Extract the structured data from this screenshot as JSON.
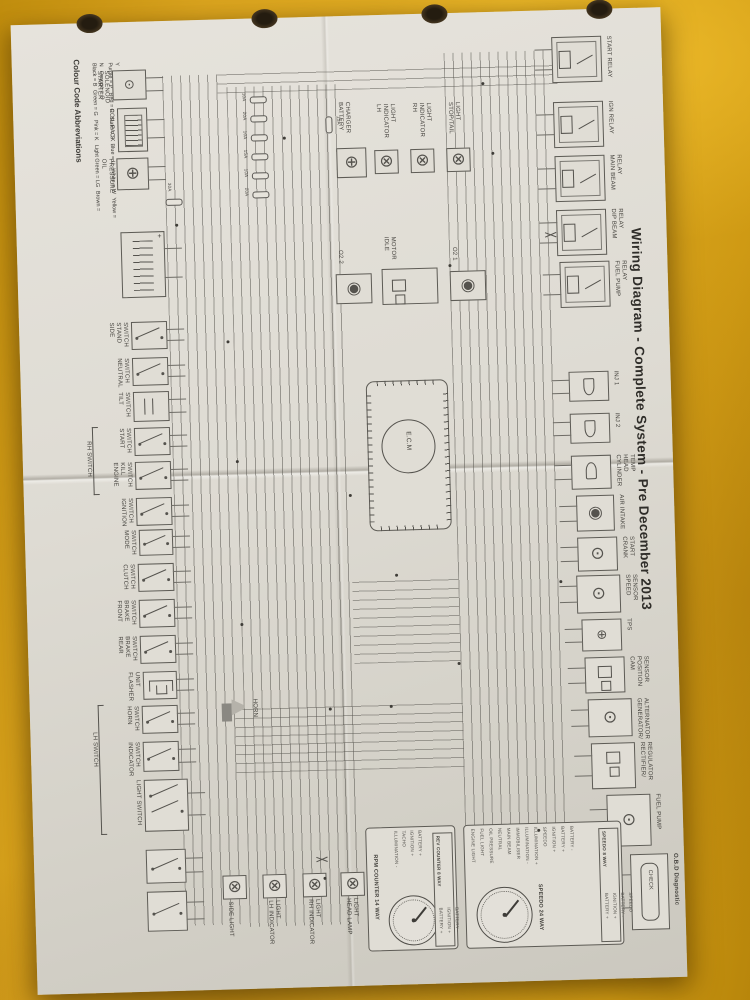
{
  "title": "Wiring Diagram - Complete System - Pre December 2013",
  "colour_codes": {
    "heading": "Colour Code Abbreviations",
    "column1": [
      "Black = B",
      "Green = G",
      "Pink = K",
      "Light Green = LG",
      "Brown = N",
      "Orange = O"
    ],
    "column2": [
      "Purple = P",
      "Red = R",
      "Slate = S",
      "Blue = U",
      "White = W",
      "Yellow = Y"
    ]
  },
  "top_left": {
    "components": [
      "STARTER SOLENOID",
      "COIL PACK",
      "OIL PRESSURE"
    ],
    "battery_fuse": "30A",
    "battery_plus": "+"
  },
  "fuse_block": {
    "ratings": [
      "10A",
      "20A",
      "10A",
      "15A",
      "10A",
      "20A"
    ],
    "aux_fuse": "15A"
  },
  "top_lamps": [
    "BATTERY CHARGER",
    "LH INDICATOR LIGHT",
    "RH INDICATOR LIGHT",
    "STOP/TAIL LIGHT"
  ],
  "switches": [
    "SIDE STAND SWITCH",
    "NEUTRAL SWITCH",
    "TILT SWITCH",
    "START SWITCH",
    "ENGINE KILL SWITCH",
    "IGNITION SWITCH",
    "MODE SWITCH",
    "CLUTCH SWITCH",
    "FRONT BRAKE SWITCH",
    "REAR BRAKE SWITCH",
    "FLASHER UNIT",
    "HORN SWITCH",
    "INDICATOR SWITCH",
    "LIGHT SWITCH"
  ],
  "switch_groups": {
    "upper": "RH SWITCH",
    "lower": "LH SWITCH"
  },
  "horn_label": "HORN",
  "center": {
    "o2_sensor_2": "O2 2",
    "idle_motor": "IDLE MOTOR",
    "o2_sensor_1": "O2 1",
    "ecu": "E.C.M"
  },
  "relays": [
    "START RELAY",
    "IGN RELAY",
    "MAIN BEAM RELAY",
    "DIP BEAM RELAY",
    "FUEL PUMP RELAY"
  ],
  "right_components": [
    "INJ 1",
    "INJ 2",
    "CYLINDER HEAD TEMP",
    "AIR INTAKE",
    "CRANK START",
    "SPEED SENSOR",
    "TPS",
    "CAM POSITION SENSOR",
    "GENERATOR/ ALTERNATOR",
    "RECTIFIER/ REGULATOR",
    "FUEL PUMP"
  ],
  "instruments": {
    "rpm": {
      "label": "RPM COUNTER 14 WAY",
      "connector": "REV COUNTER 8 WAY",
      "pins": [
        "ILLUMINATION -",
        "TACHO",
        "IGNITION +",
        "BATTERY +"
      ],
      "connector_pins": [
        "BATTERY +",
        "IGNITION +",
        "BATTERY -"
      ]
    },
    "speedo": {
      "label": "SPEEDO 24 WAY",
      "connector": "SPEEDO 8 WAY",
      "pins": [
        "ENGINE LIGHT",
        "FUEL LIGHT",
        "OIL PRESSURE",
        "NEUTRAL",
        "MAIN BEAM",
        "IMMOBILISER",
        "ILLUMINATION -",
        "ILLUMINATION +",
        "SPEEDO",
        "IGNITION +",
        "BATTERY +",
        "BATTERY -"
      ],
      "connector_pins": [
        "BATTERY +",
        "IGNITION +",
        "BATTERY -",
        "SPEEDO"
      ]
    }
  },
  "bottom_lamps": [
    "SIDE LIGHT",
    "LH INDICATOR LIGHT",
    "RH INDICATOR LIGHT",
    "HEAD LAMP LIGHT"
  ],
  "obd": {
    "connector_label": "CHECK",
    "label": "O.B.D Diagnostic"
  },
  "icons": {
    "bulb": "⊗",
    "connector": "◉",
    "sensor": "⊙",
    "charger": "⊕"
  }
}
